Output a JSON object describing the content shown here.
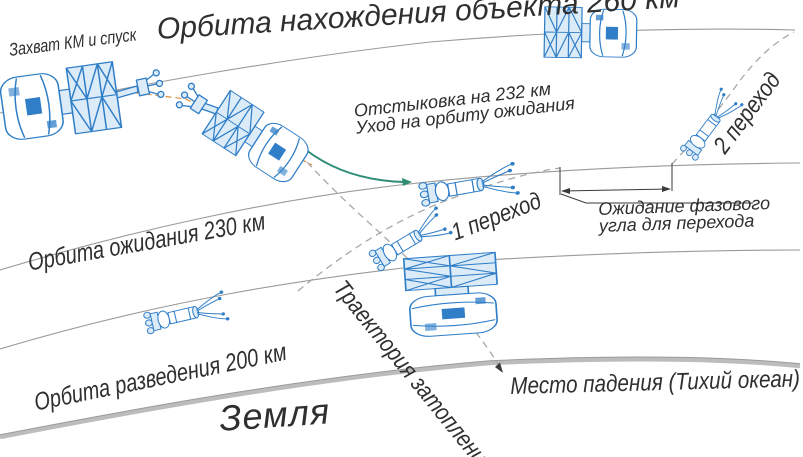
{
  "diagram": {
    "type": "space-mission-orbit-scheme",
    "language": "ru",
    "labels": {
      "orbit_260": "Орбита нахождения объекта 260 км",
      "capture": "Захват КМ и спуск",
      "undock_line1": "Отстыковка на 232 км",
      "undock_line2": "Уход на орбиту ожидания",
      "transfer_2": "2 переход",
      "transfer_1": "1 переход",
      "phase_wait_line1": "Ожидание фазового",
      "phase_wait_line2": "угла для перехода",
      "orbit_230": "Орбита ожидания 230 км",
      "orbit_200": "Орбита разведения 200 км",
      "flood_trajectory": "Траектория затопления",
      "impact_site": "Место падения (Тихий океан)",
      "earth": "Земля"
    },
    "altitudes_km": {
      "object_orbit": 260,
      "undocking": 232,
      "waiting_orbit": 230,
      "separation_orbit": 200
    },
    "icons": {
      "assembly": "docked-spacecraft-assembly-icon",
      "tug": "space-tug-with-grapple-icon"
    },
    "colors": {
      "spacecraft": "#2f7ec7",
      "spacecraft_fill": "#dcebf8",
      "orbit_line": "#9a9a9a",
      "earth_line": "#bcbcbc",
      "dashed_trajectory": "#a8a8a8",
      "undock_curve": "#2f8d76",
      "docking_axis": "#d9913f",
      "annotation": "#3a3a3a",
      "text": "#2f2f2f"
    }
  }
}
